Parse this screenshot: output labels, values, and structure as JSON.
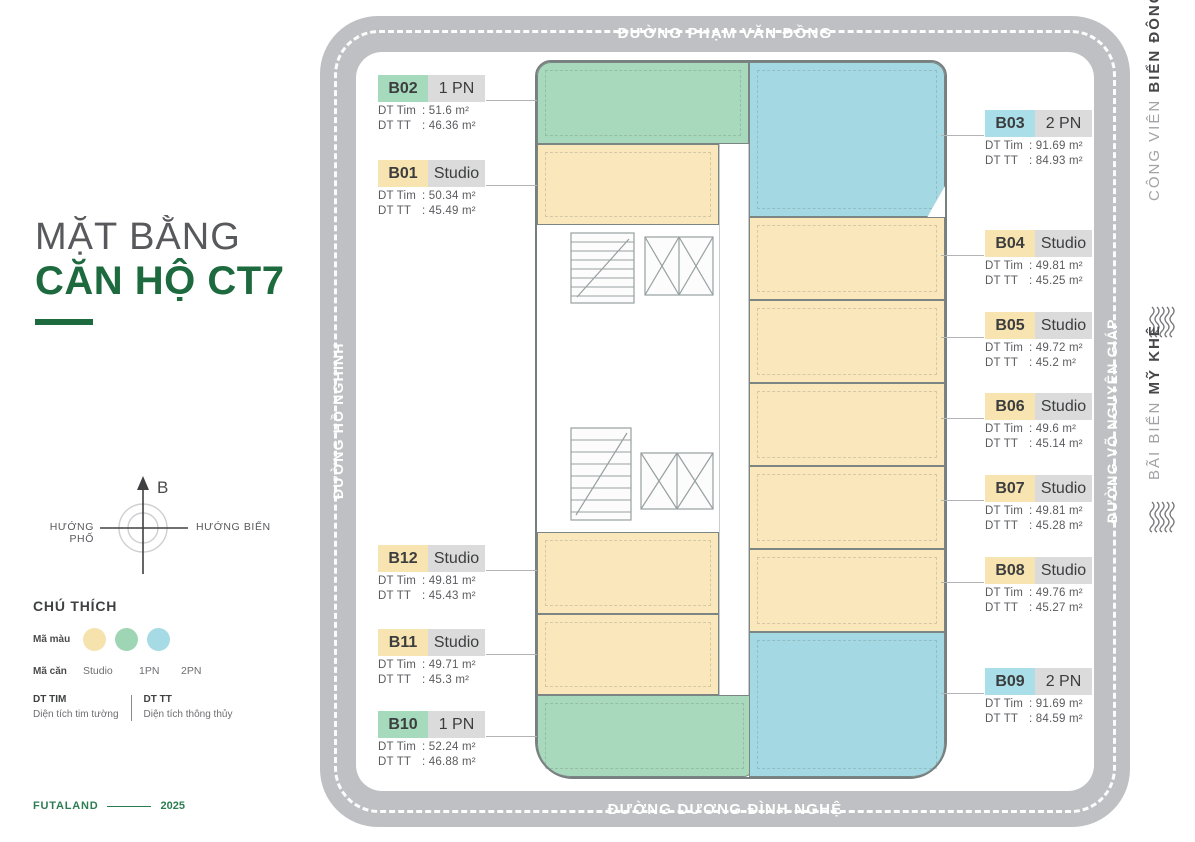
{
  "page": {
    "title_line1": "MẶT BẰNG",
    "title_line2": "CĂN HỘ CT7"
  },
  "compass": {
    "north": "B",
    "left": "HƯỚNG PHỐ",
    "right": "HƯỚNG BIỂN"
  },
  "legend": {
    "heading": "CHÚ THÍCH",
    "color_row_label": "Mã màu",
    "unit_row_label": "Mã căn",
    "types": [
      "Studio",
      "1PN",
      "2PN"
    ],
    "swatch_colors": {
      "studio": "#F6E2AC",
      "one_pn": "#9ED6B5",
      "two_pn": "#A6DAE4"
    },
    "tim_label": "DT TIM",
    "tim_desc": "Diện tích tim tường",
    "tt_label": "DT TT",
    "tt_desc": "Diện tích thông thủy"
  },
  "footer": {
    "brand": "FUTALAND",
    "year": "2025"
  },
  "streets": {
    "top": "ĐƯỜNG PHẠM VĂN ĐỒNG",
    "bottom": "ĐƯỜNG DƯƠNG ĐÌNH NGHỆ",
    "left": "ĐƯỜNG HỒ NGHINH",
    "right": "ĐƯỜNG VÕ NGUYÊN GIÁP"
  },
  "landmarks": {
    "park_prefix": "CÔNG VIÊN ",
    "park_name": "BIỂN ĐÔNG",
    "beach_prefix": "BÃI BIỂN ",
    "beach_name": "MỸ KHÊ"
  },
  "labels": {
    "dt_tim": "DT Tim",
    "dt_tt": "DT TT"
  },
  "accent_colors": {
    "brand_green": "#1d6a3f",
    "road_gray": "#bfc0c3",
    "plan_yellow": "#FAE7BC",
    "plan_green": "#A8D9BC",
    "plan_blue": "#A4D8E3"
  },
  "units": [
    {
      "code": "B02",
      "type": "1 PN",
      "tim": ": 51.6   m²",
      "tt": ": 46.36 m²"
    },
    {
      "code": "B01",
      "type": "Studio",
      "tim": ": 50.34 m²",
      "tt": ": 45.49 m²"
    },
    {
      "code": "B03",
      "type": "2 PN",
      "tim": ": 91.69  m²",
      "tt": ": 84.93 m²"
    },
    {
      "code": "B04",
      "type": "Studio",
      "tim": ": 49.81  m²",
      "tt": ": 45.25 m²"
    },
    {
      "code": "B05",
      "type": "Studio",
      "tim": ": 49.72 m²",
      "tt": ": 45.2   m²"
    },
    {
      "code": "B06",
      "type": "Studio",
      "tim": ": 49.6   m²",
      "tt": ": 45.14  m²"
    },
    {
      "code": "B07",
      "type": "Studio",
      "tim": ": 49.81 m²",
      "tt": ": 45.28 m²"
    },
    {
      "code": "B08",
      "type": "Studio",
      "tim": ": 49.76 m²",
      "tt": ": 45.27 m²"
    },
    {
      "code": "B09",
      "type": "2 PN",
      "tim": ": 91.69  m²",
      "tt": ": 84.59 m²"
    },
    {
      "code": "B12",
      "type": "Studio",
      "tim": ": 49.81  m²",
      "tt": ": 45.43 m²"
    },
    {
      "code": "B11",
      "type": "Studio",
      "tim": ": 49.71  m²",
      "tt": ": 45.3   m²"
    },
    {
      "code": "B10",
      "type": "1 PN",
      "tim": ": 52.24 m²",
      "tt": ": 46.88 m²"
    }
  ]
}
